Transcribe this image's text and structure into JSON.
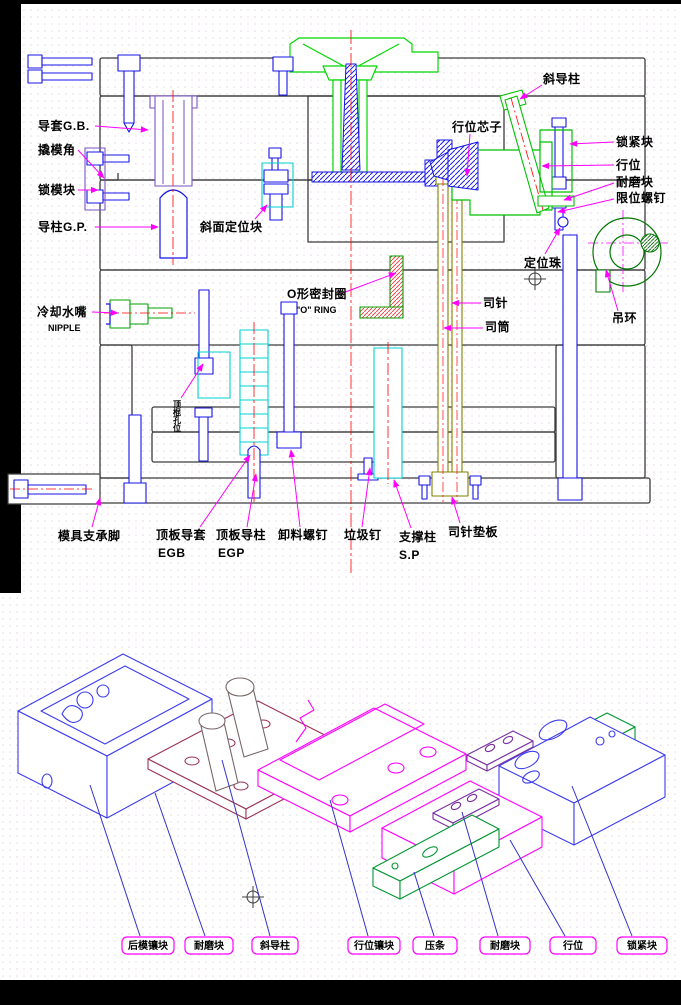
{
  "colors": {
    "background": "#ffffff",
    "frame_black": "#000000",
    "plate_outline": "#3c3c3c",
    "cad_green": "#00c000",
    "locating_ring_green": "#00d800",
    "cad_blue": "#1414e6",
    "cad_cyan": "#00d2d2",
    "centerline_red": "#ff0000",
    "leader_magenta": "#ff00ff",
    "sleeve_olive": "#808000",
    "bushing_purple": "#7a52c2",
    "plate_maroon": "#993355",
    "wear_violet": "#7b2fa0",
    "exploded_blue": "#3c3cf0",
    "exploded_green": "#009632",
    "box_label_green": "#00dd00",
    "leader_blue": "#3232cc"
  },
  "section_view": {
    "labels": [
      {
        "id": "guide-bushing",
        "text": "导套G.B."
      },
      {
        "id": "pry-angle",
        "text": "撬模角"
      },
      {
        "id": "mold-lock-block",
        "text": "锁模块"
      },
      {
        "id": "guide-pillar",
        "text": "导柱G.P."
      },
      {
        "id": "taper-locating-block",
        "text": "斜面定位块"
      },
      {
        "id": "cooling-nipple",
        "text": "冷却水嘴"
      },
      {
        "id": "cooling-nipple-en",
        "text": "NIPPLE"
      },
      {
        "id": "o-ring",
        "text": "O形密封圈"
      },
      {
        "id": "o-ring-en",
        "text": "\"O\" RING"
      },
      {
        "id": "angle-pin",
        "text": "斜导柱"
      },
      {
        "id": "slide-core",
        "text": "行位芯子"
      },
      {
        "id": "lock-block",
        "text": "锁紧块"
      },
      {
        "id": "slide",
        "text": "行位"
      },
      {
        "id": "wear-block",
        "text": "耐磨块"
      },
      {
        "id": "limit-screw",
        "text": "限位螺钉"
      },
      {
        "id": "locating-ball",
        "text": "定位珠"
      },
      {
        "id": "ejector-sleeve-pin",
        "text": "司针"
      },
      {
        "id": "ejector-sleeve",
        "text": "司筒"
      },
      {
        "id": "eyebolt",
        "text": "吊环"
      },
      {
        "id": "mold-support-foot",
        "text": "模具支承脚"
      },
      {
        "id": "ejector-guide-bush",
        "text": "顶板导套"
      },
      {
        "id": "ejector-guide-bush-en",
        "text": "EGB"
      },
      {
        "id": "ejector-guide-pillar",
        "text": "顶板导柱"
      },
      {
        "id": "ejector-guide-pillar-en",
        "text": "EGP"
      },
      {
        "id": "stripper-bolt",
        "text": "卸料螺钉"
      },
      {
        "id": "stop-pin",
        "text": "垃圾钉"
      },
      {
        "id": "support-pillar",
        "text": "支撑柱"
      },
      {
        "id": "support-pillar-en",
        "text": "S.P"
      },
      {
        "id": "sleeve-retainer-plate",
        "text": "司针垫板"
      },
      {
        "id": "ko-hole",
        "text": "顶棍孔位"
      }
    ]
  },
  "exploded_view": {
    "labels": [
      {
        "id": "rear-insert",
        "text": "后模镶块"
      },
      {
        "id": "wear-block-left",
        "text": "耐磨块"
      },
      {
        "id": "angle-pin",
        "text": "斜导柱"
      },
      {
        "id": "slide-insert",
        "text": "行位镶块"
      },
      {
        "id": "gib",
        "text": "压条"
      },
      {
        "id": "wear-block-right",
        "text": "耐磨块"
      },
      {
        "id": "slide",
        "text": "行位"
      },
      {
        "id": "lock-block",
        "text": "锁紧块"
      }
    ]
  }
}
